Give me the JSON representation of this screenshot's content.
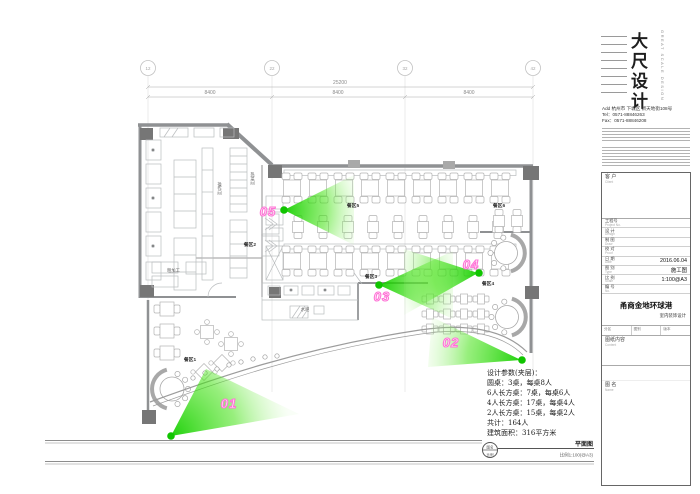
{
  "colors": {
    "cone_green": "#1ed400",
    "camera_dot_green": "#10c400",
    "camera_label_pink": "#ff73d6",
    "wall_gray": "#8f9193",
    "furniture_gray": "#b4b4b4"
  },
  "grid": {
    "bubble_labels": [
      "12",
      "22",
      "32",
      "42"
    ],
    "total_dimension": "25200",
    "segment_dimensions": [
      "8400",
      "8400",
      "8400"
    ]
  },
  "plan": {
    "zone_labels": [
      "餐区1",
      "餐区2",
      "餐区3",
      "餐区4",
      "餐区5",
      "餐区6"
    ],
    "room_labels": {
      "bar": "水吧",
      "hot_dish": "热菜间",
      "work": "操作间",
      "prep": "粗加工"
    },
    "cameras": [
      {
        "id": "01"
      },
      {
        "id": "02"
      },
      {
        "id": "03"
      },
      {
        "id": "04"
      },
      {
        "id": "05"
      }
    ]
  },
  "notes": {
    "lines": [
      "设计参数(夹层)：",
      "圆桌：3桌，每桌8人",
      "6人长方桌：7桌，每桌6人",
      "4人长方桌：17桌，每桌4人",
      "2人长方桌：15桌，每桌2人",
      "共计：164人",
      "建筑面积：316平方米"
    ]
  },
  "drawing_title": {
    "bubble_top": "图名",
    "bubble_bottom": "比例",
    "name": "平面图",
    "scale": "比例1:100(@A3)"
  },
  "titleblock": {
    "logo_cn": "大尺设计",
    "logo_en": "GREAT SCALE DESIGN",
    "address": "Add 杭州市 下城区 新天地街108号",
    "tel": "Tel：0571-88846263",
    "fax": "Fax：0571-88846208",
    "client_label": "客 户",
    "client_sub": "Client",
    "fields": [
      {
        "label": "工程号",
        "sub": "Project No.",
        "value": ""
      },
      {
        "label": "设 计",
        "sub": "Design",
        "value": ""
      },
      {
        "label": "制 图",
        "sub": "Draw",
        "value": ""
      },
      {
        "label": "校 对",
        "sub": "Proof",
        "value": ""
      },
      {
        "label": "日 期",
        "sub": "Date",
        "value": "2016.06.04"
      },
      {
        "label": "图 别",
        "sub": "Type",
        "value": "施工图"
      },
      {
        "label": "比 例",
        "sub": "Scale",
        "value": "1:100@A3"
      },
      {
        "label": "编 号",
        "sub": "No.",
        "value": ""
      }
    ],
    "project_name": "甬商金地环球港",
    "project_sub": "室内装饰设计",
    "stage_cols": [
      "分区",
      "图别",
      "版本"
    ],
    "content_label": "图纸内容",
    "content_sub": "Content",
    "name_label": "图 名",
    "name_sub": "Name"
  }
}
